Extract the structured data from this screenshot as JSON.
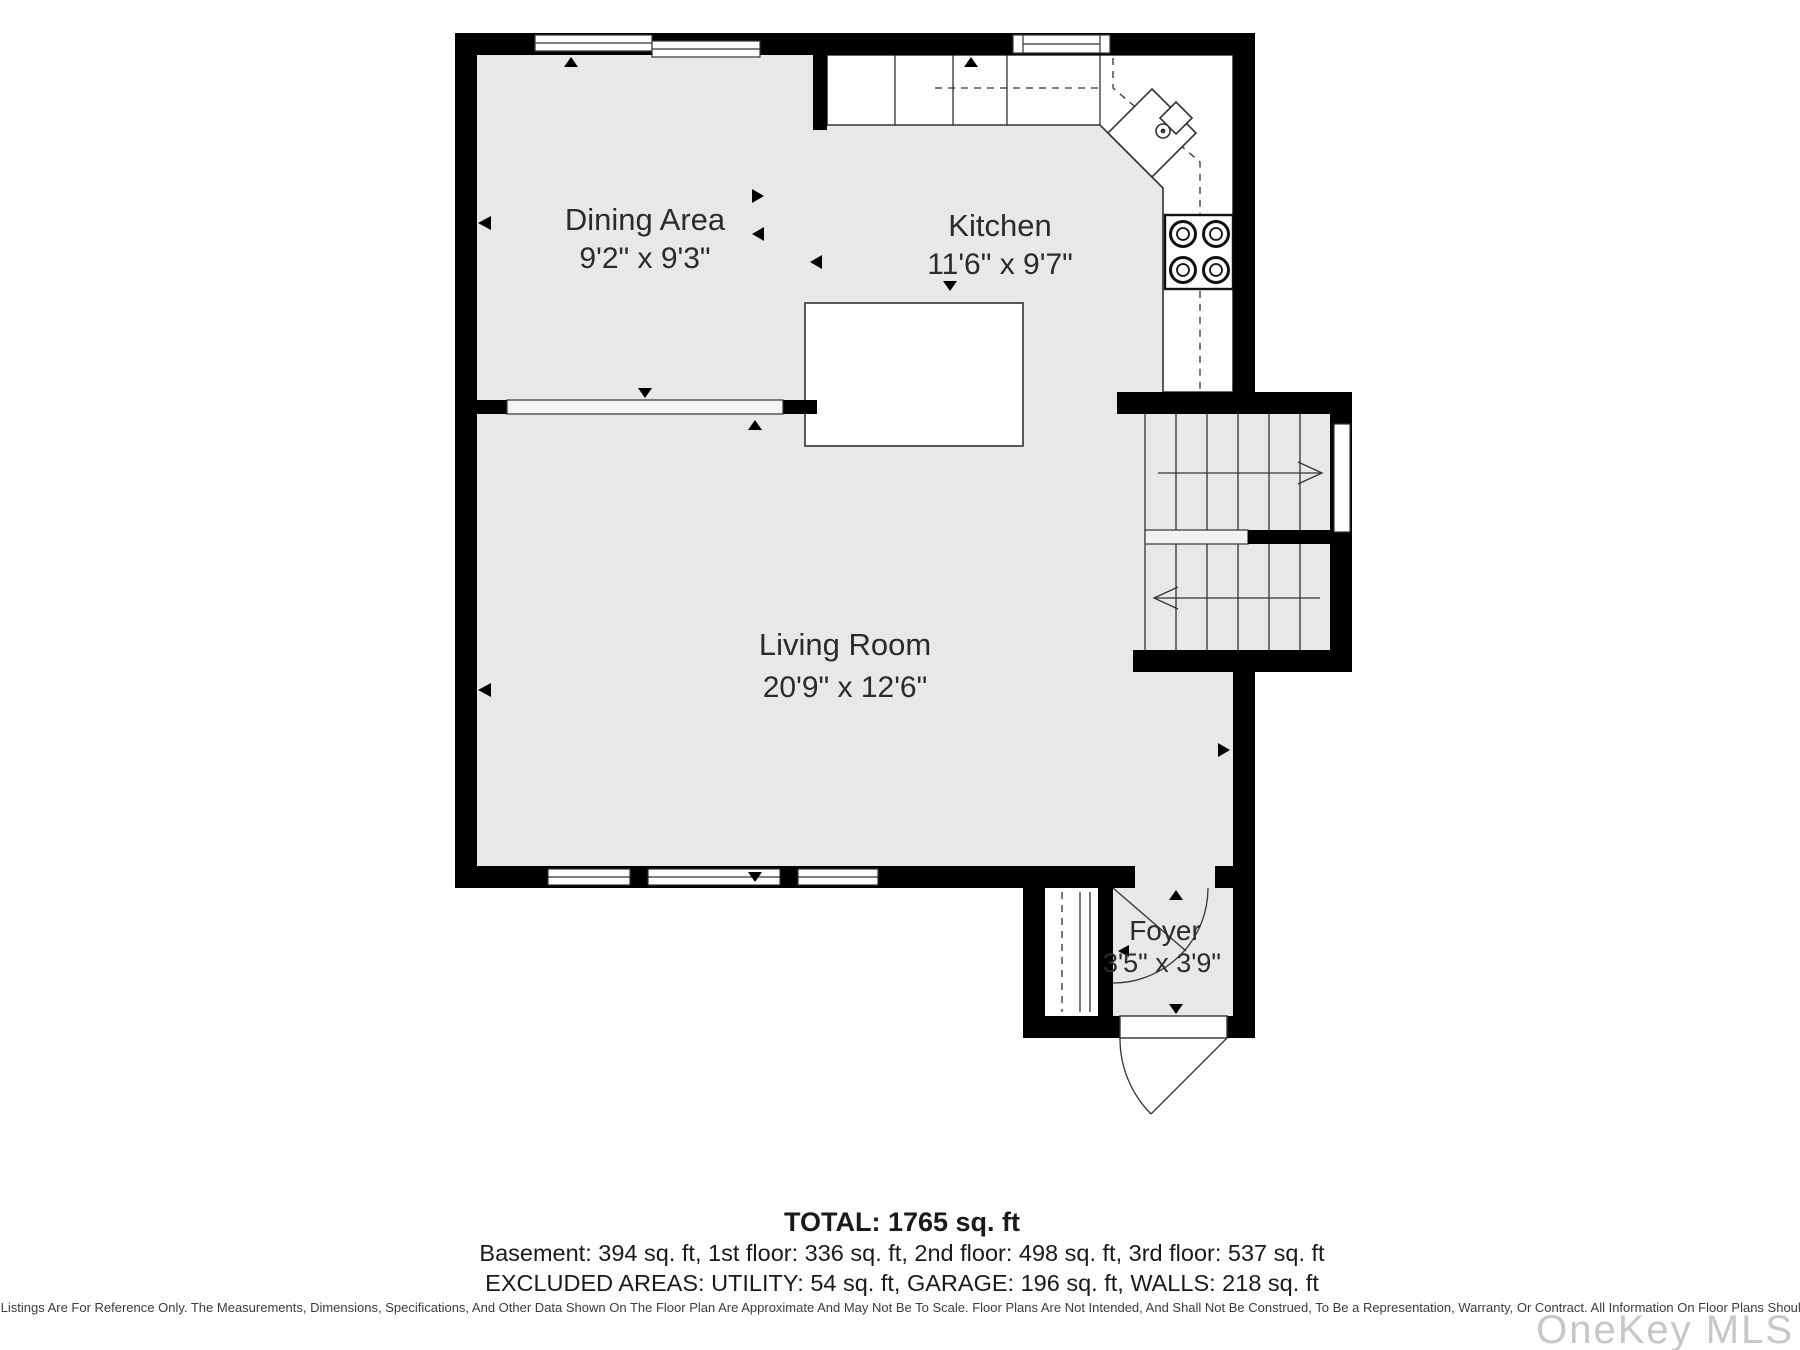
{
  "plan": {
    "rooms": [
      {
        "name": "Dining Area",
        "dims": "9'2\" x 9'3\""
      },
      {
        "name": "Kitchen",
        "dims": "11'6\" x 9'7\""
      },
      {
        "name": "Living Room",
        "dims": "20'9\" x 12'6\""
      },
      {
        "name": "Foyer",
        "dims": "3'5\" x 3'9\""
      }
    ]
  },
  "summary": {
    "total": "TOTAL: 1765 sq. ft",
    "floors": "Basement: 394 sq. ft, 1st floor: 336 sq. ft, 2nd floor: 498 sq. ft, 3rd floor: 537 sq. ft",
    "excluded": "EXCLUDED AREAS: UTILITY: 54 sq. ft, GARAGE: 196 sq. ft, WALLS: 218 sq. ft"
  },
  "footer": {
    "disclaimer": "Floor Plans Provided In Our Listings Are For Reference Only. The Measurements, Dimensions, Specifications, And Other Data Shown On The Floor Plan Are Approximate And May Not Be To Scale. Floor Plans Are Not Intended, And Shall Not Be Construed, To Be a Representation, Warranty, Or Contract. All Information On Floor Plans Should Be Independently Verified.",
    "watermark": "OneKey MLS"
  },
  "colors": {
    "wall": "#000000",
    "floor": "#e8e8e8",
    "line": "#333333",
    "text": "#2b2b2b",
    "watermark": "#c7c7c7"
  }
}
